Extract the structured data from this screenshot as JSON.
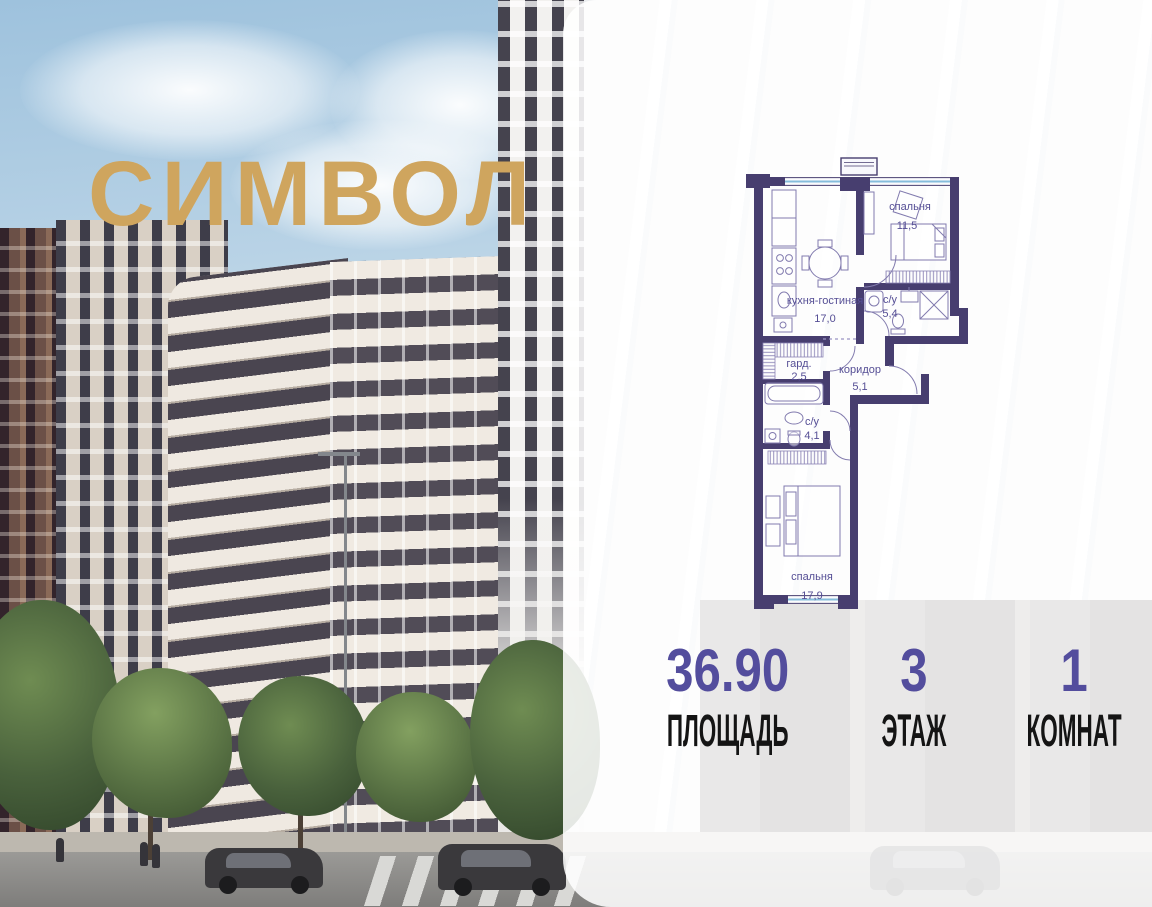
{
  "logo": {
    "text": "СИМВОЛ",
    "color": "#CFA55E"
  },
  "floorplan": {
    "wall_color": "#473E6F",
    "label_color": "#554E95",
    "window_color": "#86BDDC",
    "rooms": [
      {
        "id": "bedroom-top",
        "name": "спальня",
        "area": "11,5"
      },
      {
        "id": "kitchen-living",
        "name": "кухня-гостиная",
        "area": "17,0"
      },
      {
        "id": "bathroom-top",
        "name": "с/у",
        "area": "5,4"
      },
      {
        "id": "wardrobe",
        "name": "гард.",
        "area": "2,5"
      },
      {
        "id": "corridor",
        "name": "коридор",
        "area": "5,1"
      },
      {
        "id": "bathroom-bottom",
        "name": "с/у",
        "area": "4,1"
      },
      {
        "id": "bedroom-bottom",
        "name": "спальня",
        "area": "17,9"
      }
    ]
  },
  "stats": {
    "accent_color": "#534D9D",
    "items": [
      {
        "value": "36.90",
        "label": "ПЛОЩАДЬ"
      },
      {
        "value": "3",
        "label": "ЭТАЖ"
      },
      {
        "value": "1",
        "label": "КОМНАТ"
      }
    ]
  }
}
